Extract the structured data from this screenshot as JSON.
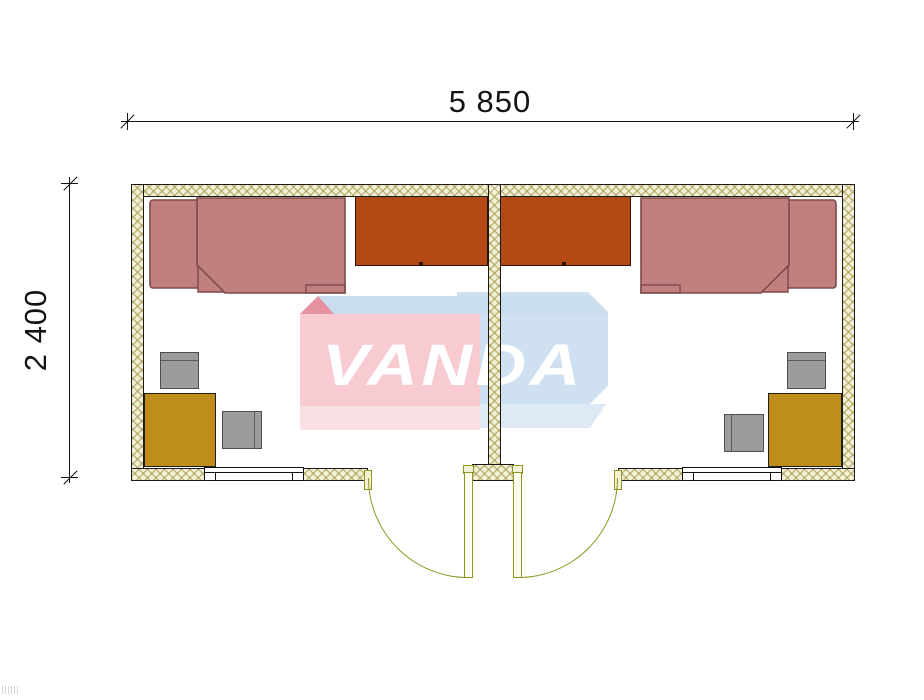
{
  "dimensions": {
    "width_label": "5 850",
    "height_label": "2 400"
  },
  "watermark": {
    "text": "VANDA"
  },
  "colors": {
    "wall_fill": "#f3f0d8",
    "wall_hatch": "rgba(164,152,74,0.65)",
    "bed_fill": "#c1807f",
    "bed_border": "#7d4a4a",
    "wardrobe_fill": "#b34a16",
    "desk_fill": "#bf8d1a",
    "chair_fill": "#9c9c9c",
    "door": "#8f951f",
    "wm_pink": "#f8cad2",
    "wm_pink_skirt": "#fadfe3",
    "wm_pink_dark": "#e6919f",
    "wm_blue": "#cfe1f1",
    "wm_blue_top": "#c9ddee",
    "wm_blue_skirt": "#dde9f5",
    "wm_red": "#de4040",
    "wm_text": "#ffffff"
  }
}
